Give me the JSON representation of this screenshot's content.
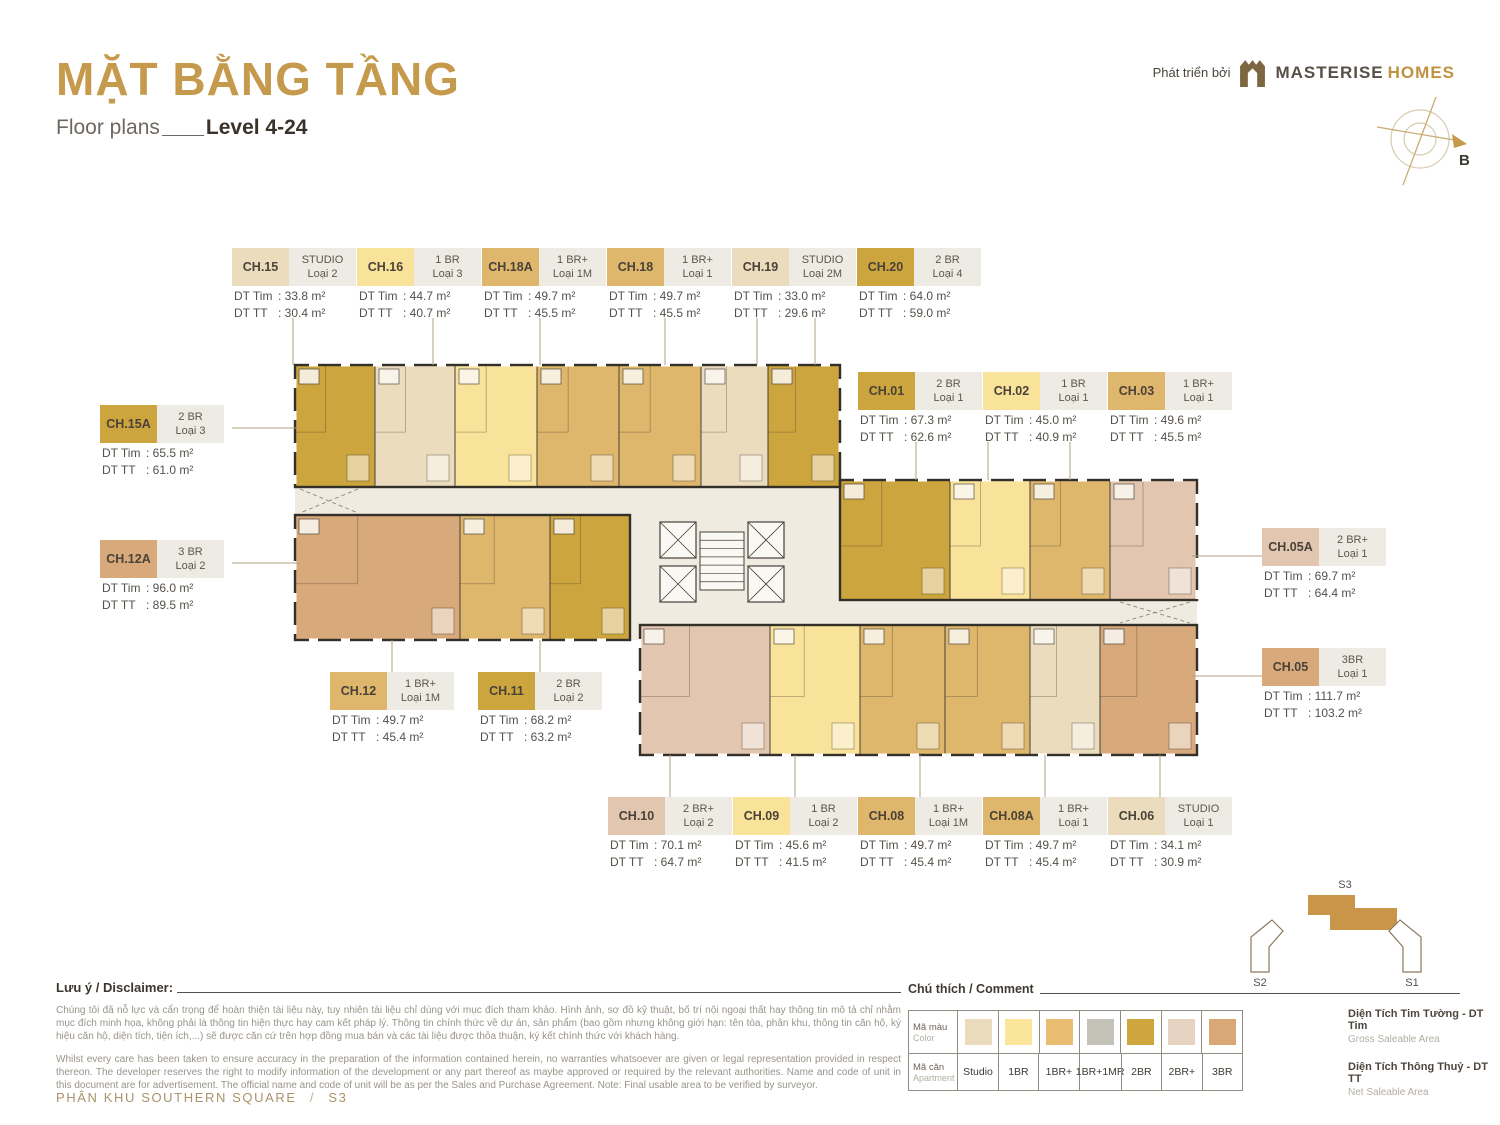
{
  "header": {
    "title": "MẶT BẰNG TẦNG",
    "subtitle_left": "Floor plans",
    "subtitle_right": "Level 4-24",
    "developer_prefix": "Phát triển bởi",
    "developer_name_1": "MASTERISE",
    "developer_name_2": "HOMES"
  },
  "compass": {
    "label": "B"
  },
  "area_labels": {
    "tim": "DT Tim",
    "tt": "DT TT"
  },
  "type_colors": {
    "studio": "#EBDCBE",
    "1br": "#F9E29A",
    "1brp": "#DFB76C",
    "1brp1mr": "#C5C3B7",
    "2br": "#CDA53F",
    "2brp": "#E2C6AF",
    "3br": "#D8A97A"
  },
  "callouts": [
    {
      "id": "CH.15",
      "type": "STUDIO",
      "loai": "Loại 2",
      "dt_tim": ": 33.8 m²",
      "dt_tt": ": 30.4 m²",
      "type_key": "studio"
    },
    {
      "id": "CH.16",
      "type": "1 BR",
      "loai": "Loại 3",
      "dt_tim": ": 44.7 m²",
      "dt_tt": ": 40.7 m²",
      "type_key": "1br"
    },
    {
      "id": "CH.18A",
      "type": "1 BR+",
      "loai": "Loại 1M",
      "dt_tim": ": 49.7 m²",
      "dt_tt": ": 45.5 m²",
      "type_key": "1brp"
    },
    {
      "id": "CH.18",
      "type": "1 BR+",
      "loai": "Loại 1",
      "dt_tim": ": 49.7 m²",
      "dt_tt": ": 45.5 m²",
      "type_key": "1brp"
    },
    {
      "id": "CH.19",
      "type": "STUDIO",
      "loai": "Loại 2M",
      "dt_tim": ": 33.0 m²",
      "dt_tt": ": 29.6 m²",
      "type_key": "studio"
    },
    {
      "id": "CH.20",
      "type": "2 BR",
      "loai": "Loại 4",
      "dt_tim": ": 64.0 m²",
      "dt_tt": ": 59.0 m²",
      "type_key": "2br"
    },
    {
      "id": "CH.01",
      "type": "2 BR",
      "loai": "Loại 1",
      "dt_tim": ": 67.3 m²",
      "dt_tt": ": 62.6 m²",
      "type_key": "2br"
    },
    {
      "id": "CH.02",
      "type": "1 BR",
      "loai": "Loại 1",
      "dt_tim": ": 45.0 m²",
      "dt_tt": ": 40.9 m²",
      "type_key": "1br"
    },
    {
      "id": "CH.03",
      "type": "1 BR+",
      "loai": "Loại 1",
      "dt_tim": ": 49.6 m²",
      "dt_tt": ": 45.5 m²",
      "type_key": "1brp"
    },
    {
      "id": "CH.15A",
      "type": "2 BR",
      "loai": "Loại 3",
      "dt_tim": ": 65.5 m²",
      "dt_tt": ": 61.0 m²",
      "type_key": "2br"
    },
    {
      "id": "CH.12A",
      "type": "3 BR",
      "loai": "Loại 2",
      "dt_tim": ": 96.0 m²",
      "dt_tt": ": 89.5 m²",
      "type_key": "3br"
    },
    {
      "id": "CH.05A",
      "type": "2 BR+",
      "loai": "Loại 1",
      "dt_tim": ": 69.7 m²",
      "dt_tt": ": 64.4 m²",
      "type_key": "2brp"
    },
    {
      "id": "CH.05",
      "type": "3BR",
      "loai": "Loại 1",
      "dt_tim": ": 111.7 m²",
      "dt_tt": ": 103.2 m²",
      "type_key": "3br"
    },
    {
      "id": "CH.12",
      "type": "1 BR+",
      "loai": "Loại 1M",
      "dt_tim": ": 49.7 m²",
      "dt_tt": ": 45.4 m²",
      "type_key": "1brp"
    },
    {
      "id": "CH.11",
      "type": "2 BR",
      "loai": "Loại 2",
      "dt_tim": ": 68.2 m²",
      "dt_tt": ": 63.2 m²",
      "type_key": "2br"
    },
    {
      "id": "CH.10",
      "type": "2 BR+",
      "loai": "Loại 2",
      "dt_tim": ": 70.1 m²",
      "dt_tt": ": 64.7 m²",
      "type_key": "2brp"
    },
    {
      "id": "CH.09",
      "type": "1 BR",
      "loai": "Loại 2",
      "dt_tim": ": 45.6 m²",
      "dt_tt": ": 41.5 m²",
      "type_key": "1br"
    },
    {
      "id": "CH.08",
      "type": "1 BR+",
      "loai": "Loại 1M",
      "dt_tim": ": 49.7 m²",
      "dt_tt": ": 45.4 m²",
      "type_key": "1brp"
    },
    {
      "id": "CH.08A",
      "type": "1 BR+",
      "loai": "Loại 1",
      "dt_tim": ": 49.7 m²",
      "dt_tt": ": 45.4 m²",
      "type_key": "1brp"
    },
    {
      "id": "CH.06",
      "type": "STUDIO",
      "loai": "Loại 1",
      "dt_tim": ": 34.1 m²",
      "dt_tt": ": 30.9 m²",
      "type_key": "studio"
    }
  ],
  "legend": {
    "title": "Chú thích / Comment",
    "row1_label": "Mã màu",
    "row1_sub": "Color",
    "row2_label": "Mã căn",
    "row2_sub": "Apartment",
    "types": [
      {
        "label": "Studio",
        "color": "#EBDCBE"
      },
      {
        "label": "1BR",
        "color": "#FBE59B"
      },
      {
        "label": "1BR+",
        "color": "#E9BE72"
      },
      {
        "label": "1BR+1MR",
        "color": "#C5C3B7"
      },
      {
        "label": "2BR",
        "color": "#CFA53E"
      },
      {
        "label": "2BR+",
        "color": "#E6D3C1"
      },
      {
        "label": "3BR",
        "color": "#D8A876"
      }
    ]
  },
  "area_defs": [
    {
      "vi": "Diện Tích Tim Tường - DT Tim",
      "en": "Gross Saleable Area"
    },
    {
      "vi": "Diện Tích Thông Thuỷ - DT TT",
      "en": "Net Saleable Area"
    }
  ],
  "disclaimer": {
    "title": "Lưu ý / Disclaimer:",
    "vi": "Chúng tôi đã nỗ lực và cẩn trọng để hoàn thiện tài liệu này, tuy nhiên tài liệu chỉ dùng với mục đích tham khảo. Hình ảnh, sơ đồ kỹ thuật, bố trí nội ngoại thất hay thông tin mô tả chỉ nhằm mục đích minh họa, không phải là thông tin hiện thực hay cam kết pháp lý. Thông tin chính thức về dự án, sản phẩm (bao gồm nhưng không giới hạn: tên tòa, phân khu, thông tin căn hộ, ký hiệu căn hộ, diện tích, tiện ích,...) sẽ được căn cứ trên hợp đồng mua bán và các tài liệu được thỏa thuận, ký kết chính thức với khách hàng.",
    "en": "Whilst every care has been taken to ensure accuracy in the preparation of the information contained herein, no warranties whatsoever are given or legal representation provided in respect thereon. The developer reserves the right to modify information of the development or any part thereof as maybe approved or required by the relevant authorities. Name and code of unit in this document are for advertisement. The official name and code of unit will be as per the Sales and Purchase Agreement. Note: Final usable area to be verified by surveyor."
  },
  "footer": {
    "zone": "PHÂN KHU SOUTHERN SQUARE",
    "sep": "/",
    "code": "S3"
  },
  "minimap": {
    "s3": "S3",
    "s2": "S2",
    "s1": "S1"
  }
}
